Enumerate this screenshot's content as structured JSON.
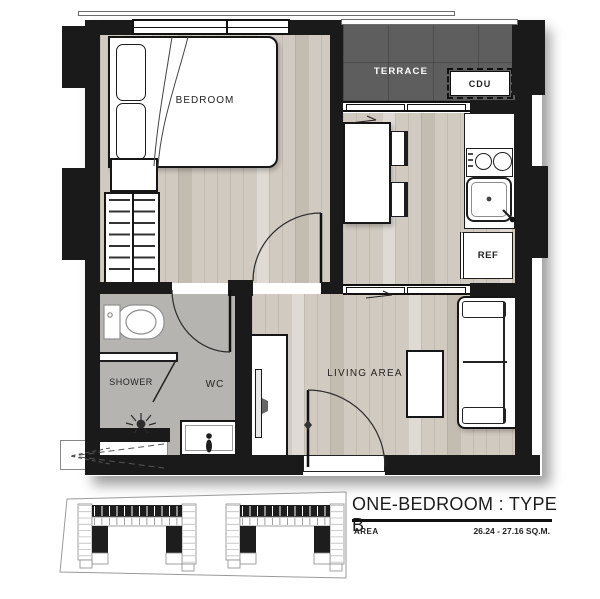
{
  "floor_plan": {
    "labels": {
      "bedroom": "BEDROOM",
      "terrace": "TERRACE",
      "cdu": "CDU",
      "ref": "REF",
      "shower": "SHOWER",
      "wc": "WC",
      "living": "LIVING AREA"
    },
    "colors": {
      "wall": "#1a1a1a",
      "wood_floor": "#d1cac0",
      "terrace_floor": "#5e5e5e",
      "bath_floor": "#b5b4b1"
    }
  },
  "title_block": {
    "title": "ONE-BEDROOM : TYPE B",
    "area_label": "AREA",
    "area_value": "26.24 - 27.16 SQ.M."
  }
}
